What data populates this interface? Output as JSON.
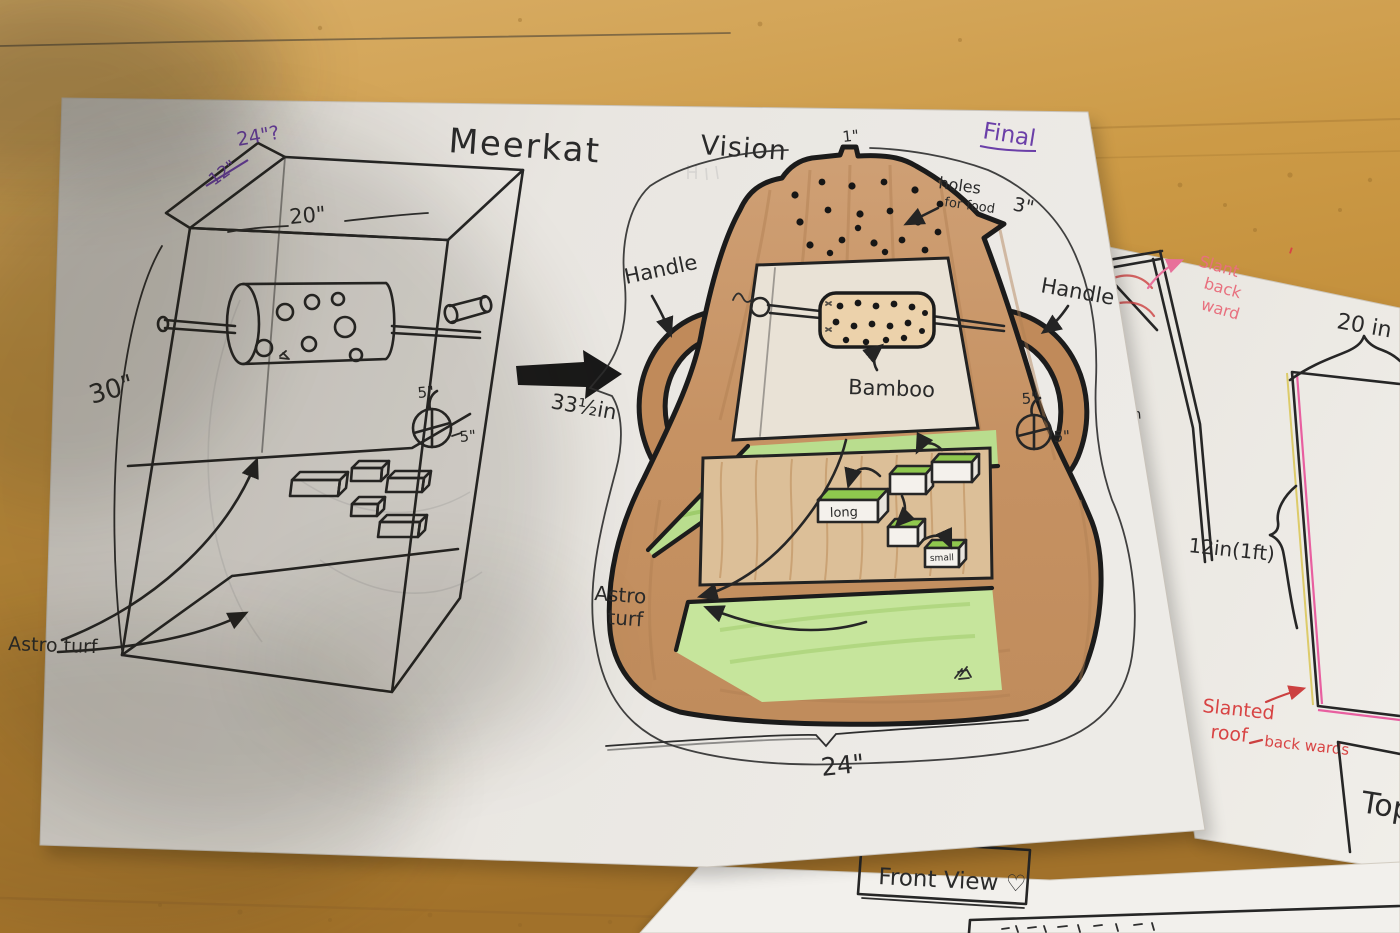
{
  "scene": {
    "type": "photograph of hand-drawn design sketches on a wooden desk",
    "subject": "Meerkat Vision enclosure design"
  },
  "colors": {
    "ink": "#262626",
    "purple_pen": "#6b3fa8",
    "pink_pen": "#e8707e",
    "red_pen": "#d84444",
    "body_brown": "#c79567",
    "green": "#b9dd8e",
    "bamboo_tan": "#ecd2ab",
    "wood": "#c9953f",
    "paper": "#eae7e2"
  },
  "main_paper": {
    "title_left": "Meerkat",
    "title_right": "Vision",
    "final_note": "Final",
    "left_sketch": {
      "dim_lid": "24\"?",
      "dim_crossed": "12\"",
      "dim_width": "20\"",
      "dim_height": "30\"",
      "ball_dim_top": "5\"",
      "ball_dim_side": "5\"",
      "floor_label": "Astro turf"
    },
    "transfer_dim": "33½in",
    "center_sketch": {
      "handle_left": "Handle",
      "handle_right": "Handle",
      "holes_note_line1": "holes",
      "holes_note_line2": "for food",
      "dim_peak": "1\"",
      "dim_right": "3\"",
      "bamboo_label": "Bamboo",
      "ball_dim_top": "5\"",
      "ball_dim_side": "5\"",
      "block_label_long": "long",
      "block_label_small": "small",
      "turf_note_line1": "Astro",
      "turf_note_line2": "turf",
      "dim_bottom": "24\""
    }
  },
  "right_paper": {
    "slant_note_line1": "Slant",
    "slant_note_line2": "back",
    "slant_note_line3": "ward",
    "stray_mark": "'",
    "dim_top": "20 in",
    "dim_edge": "1in",
    "dim_left": "12in(1ft)",
    "roof_note_line1": "Slanted",
    "roof_note_line2": "roof",
    "roof_note_line3": "back wards",
    "view_label": "Top"
  },
  "bottom_paper": {
    "view_label": "Front View ♡"
  }
}
